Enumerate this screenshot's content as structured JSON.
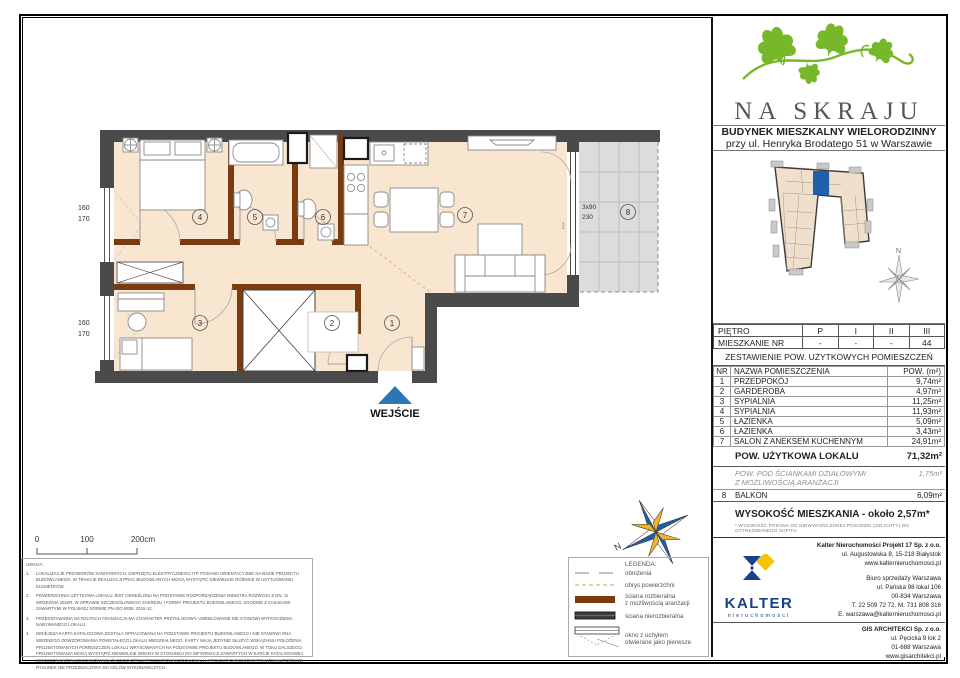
{
  "header": {
    "project_name": "NA SKRAJU",
    "building_line1": "BUDYNEK MIESZKALNY WIELORODZINNY",
    "building_line2": "przy ul. Henryka Brodatego 51 w Warszawie"
  },
  "plan": {
    "entrance_label": "WEJŚCIE",
    "rooms": [
      "1",
      "2",
      "3",
      "4",
      "5",
      "6",
      "7",
      "8"
    ],
    "dims": {
      "w1a": "160",
      "w1b": "170",
      "w2a": "160",
      "w2b": "170",
      "balc1": "3x90",
      "balc2": "230",
      "fix": "FIX"
    },
    "scale0": "0",
    "scale1": "100",
    "scale2": "200cm",
    "compass_n": "N"
  },
  "floor_table": {
    "floor_label": "PIĘTRO",
    "floors": [
      "P",
      "I",
      "II",
      "III"
    ],
    "apt_label": "MIESZKANIE NR",
    "apt_values": [
      "-",
      "-",
      "-",
      "44"
    ]
  },
  "area_table": {
    "title": "ZESTAWIENIE POW. UŻYTKOWYCH POMIESZCZEŃ",
    "col_nr": "NR",
    "col_name": "NAZWA POMIESZCZENIA",
    "col_area": "POW. (m²)",
    "rows": [
      {
        "nr": "1",
        "name": "PRZEDPOKÓJ",
        "area": "9,74m²"
      },
      {
        "nr": "2",
        "name": "GARDEROBA",
        "area": "4,97m²"
      },
      {
        "nr": "3",
        "name": "SYPIALNIA",
        "area": "11,25m²"
      },
      {
        "nr": "4",
        "name": "SYPIALNIA",
        "area": "11,93m²"
      },
      {
        "nr": "5",
        "name": "ŁAZIENKA",
        "area": "5,09m²"
      },
      {
        "nr": "6",
        "name": "ŁAZIENKA",
        "area": "3,43m²"
      },
      {
        "nr": "7",
        "name": "SALON Z ANEKSEM KUCHENNYM",
        "area": "24,91m²"
      }
    ],
    "total_label": "POW. UŻYTKOWA LOKALU",
    "total_area": "71,32m²",
    "partition_line1": "POW. POD ŚCIANKAMI DZIAŁOWYMI",
    "partition_line2": "Z MOŻLIWOŚCIĄ ARANŻACJI",
    "partition_area": "1,75m²",
    "balcony_nr": "8",
    "balcony_label": "BALKON",
    "balcony_area": "6,09m²"
  },
  "height_info": {
    "text": "WYSOKOŚĆ MIESZKANIA - około 2,57m*",
    "footnote": "* WYSOKOŚĆ PODANA OD NIEWYKOŃCZONEJ POSADZKI (SZLICHTY) DO OTYNKOWANEGO SUFITU"
  },
  "developer": {
    "brand": "KALTER",
    "brand_sub": "nieruchomości",
    "company": "Kalter Nieruchomości Projekt 17 Sp. z o.o.",
    "address1": "ul. Augustowska 8, 15-218 Białystok",
    "website": "www.kalternieruchomosci.pl",
    "office": [
      "Biuro sprzedaży Warszawa",
      "ul. Pańska 98 lokal 106",
      "00-834 Warszawa",
      "T. 22 509 72 72. M. 731 808 316",
      "E. warszawa@kalternieruchomosci.pl"
    ],
    "architect": {
      "name": "GIS ARCHITEKCI Sp. z o.o.",
      "lines": [
        "ul. Pęcicka 9 lok 2",
        "01-688 Warszawa",
        "www.gisarchitekci.pl"
      ]
    }
  },
  "legend": {
    "title": "LEGENDA:",
    "items": [
      {
        "t": "obniżenia"
      },
      {
        "t": "obrys powierzchni"
      },
      {
        "t": "ściana rozbieralna",
        "t2": "z możliwością aranżacji"
      },
      {
        "t": "ściana nierozbieralna"
      },
      {
        "t": "okno z uchyłem",
        "t2": "otwierane jako pierwsze"
      }
    ]
  },
  "notes": {
    "title": "UWAGA:",
    "items": [
      "LOKALIZACJE PRZYBORÓW SANITARNYCH, OSPRZĘTU ELEKTRYCZNEGO ITP. PODANO ORIENTACYJNIE NA BAZIE PROJEKTU BUDOWLANEGO. W TRAKCIE REALIZACJI PRAC BUDOWLANYCH MOGĄ WYSTĄPIĆ NIEWIELKIE RÓŻNICE W USYTUOWANIU ELEMENTÓW.",
      "POWIERZCHNIA UŻYTKOWA LOKALU JEST OKREŚLONA NA PODSTAWIE ROZPORZĄDZENIA MINISTRA ROZWOJU Z DN. 11 WRZEŚNIA 2020R. W SPRAWIE SZCZEGÓŁOWEGO ZAKRESU I FORMY PROJEKTU BUDOWLANEGO, ZGODNIE Z ZASADAMI ZAWARTYMI W POLSKIEJ NORMIE PN-ISO 9836: 2015-12.",
      "PRZEDSTAWIONA NA RZUTACH ARANŻACJA MA CHARAKTER PRZYKŁADOWY. UMEBLOWANIE NIE STANOWI WYPOSAŻENIA NABYWANEGO LOKALU.",
      "NINIEJSZA KARTA KATALOGOWA ZOSTAŁA OPRACOWANA NA PODSTAWIE PROJEKTU BUDOWLANEGO I NIE STANOWI ONA WIERNEGO ODWZOROWANIA POWSTAŁEGO LOKALU MIESZKALNEGO. KARTY MAJĄ JEDYNIE SŁUŻYĆ WSKAZANIU POŁOŻENIA PROJEKTOWANYCH POMIESZCZEŃ LOKALU WRYSOWANYCH NA PODSTAWIE PROJEKTU BUDOWLANEGO. W TOKU DALSZEGO PROJEKTOWANIA MOGĄ WYSTĄPIĆ NIEWIELKIE ZMIANY W STOSUNKU DO INFORMACJI ZAWARTYCH W KARCIE KATALOGOWEJ. NINIEJSZA KARTA NIE STANOWI WIĄŻĄCEGO OPISU PREZENTOWANEGO LOKALU. PROJEKT CHRONIONY PRAWEM AUTORSKIM. RYSUNEK NIE PRZEZNACZONY DO CELÓW WYKONAWCZYCH."
    ]
  },
  "colors": {
    "accent_blue": "#2e75b6",
    "wall_dark": "#4a4a4a",
    "wall_brown": "#7a3b0f",
    "floor": "#f9e6d0",
    "ivy_green": "#76b82a",
    "kalter_blue": "#16418c",
    "kalter_yellow": "#f5c400"
  }
}
